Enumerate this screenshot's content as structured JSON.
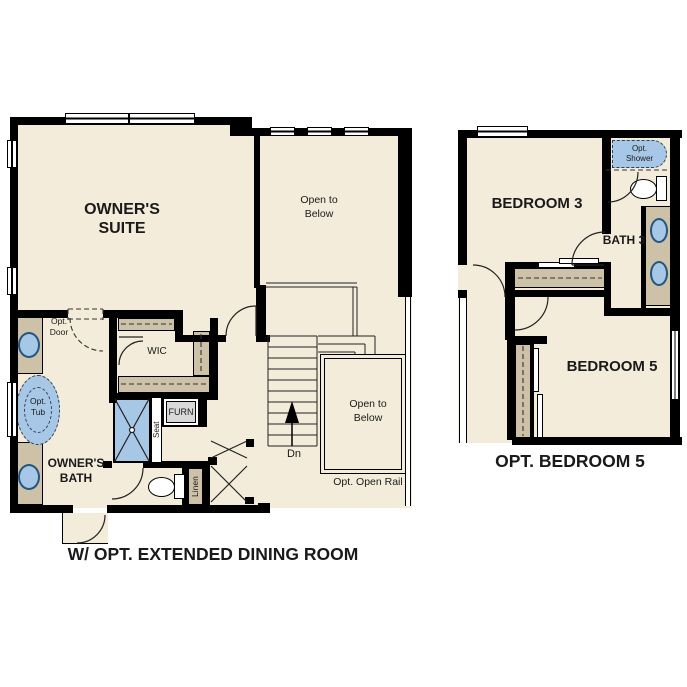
{
  "colors": {
    "floor": "#f4ecda",
    "wall": "#000000",
    "cabinet": "#cdc1a8",
    "fixture_blue": "#a7c7e7",
    "fixture_blue_border": "#24557e",
    "furnace_gray": "#d9d9d9"
  },
  "left_plan": {
    "caption": "W/ OPT. EXTENDED DINING ROOM",
    "labels": {
      "owners_suite": "OWNER'S SUITE",
      "open_to_below_upper": "Open to Below",
      "open_to_below_lower": "Open to Below",
      "opt_door": "Opt. Door",
      "opt_tub": "Opt. Tub",
      "wic": "WIC",
      "furn": "FURN",
      "seat": "Seat",
      "owners_bath": "OWNER'S BATH",
      "linen": "Linen",
      "down": "Dn",
      "opt_open_rail": "Opt. Open Rail"
    }
  },
  "right_plan": {
    "caption": "OPT. BEDROOM 5",
    "labels": {
      "bedroom_3": "BEDROOM 3",
      "opt_shower": "Opt. Shower",
      "bath_3": "BATH 3",
      "bedroom_5": "BEDROOM 5"
    }
  }
}
